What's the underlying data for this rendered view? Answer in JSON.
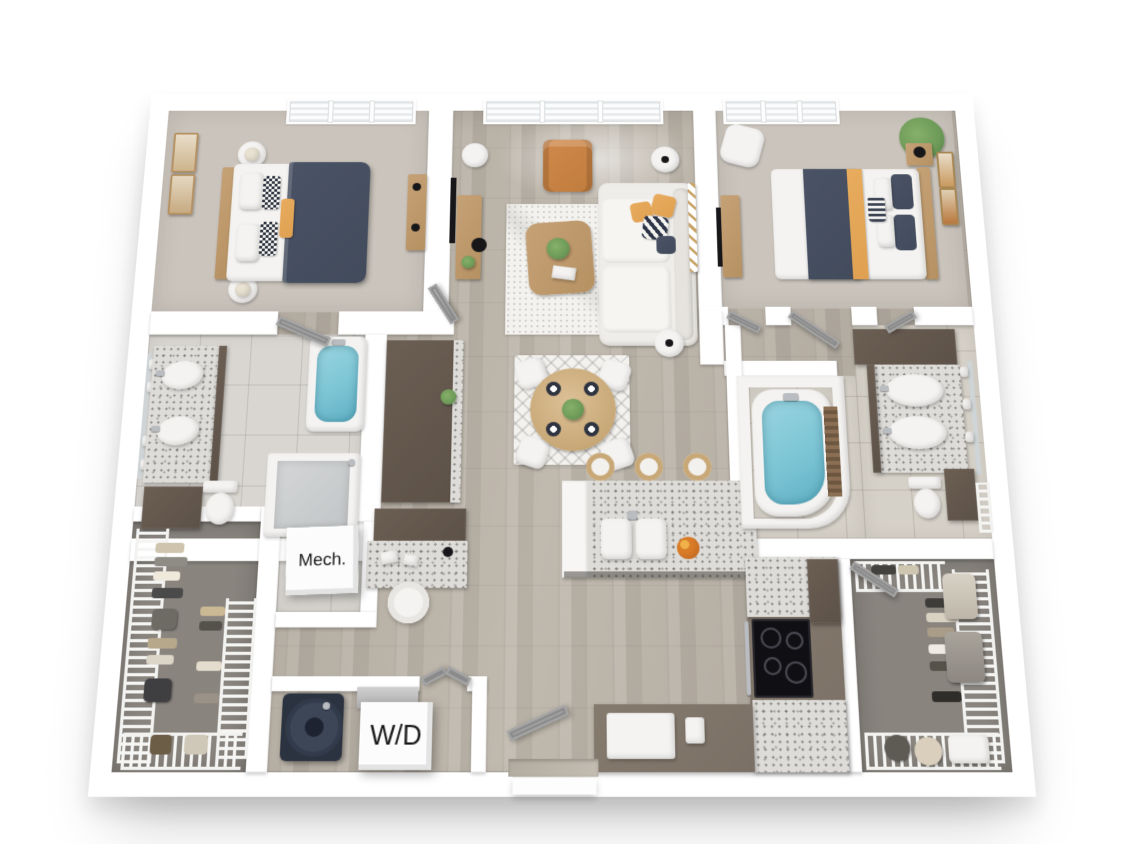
{
  "labels": {
    "mech": "Mech.",
    "wd": "W/D"
  },
  "colors": {
    "wall": "#ffffff",
    "wood": "#c0b9ae",
    "wood2": "#aba398",
    "carpet": "#cac4bc",
    "carpet_dark": "#89847e",
    "tile": "#d9d6d1",
    "tile_beige": "#d6d1c8",
    "granite": "#dedcd8",
    "cabinet_dark": "#5d5248",
    "cabinet_taupe": "#7b7065",
    "wood_furniture": "#b59162",
    "navy": "#424b5c",
    "orange": "#dfa051",
    "leather": "#c07c3e",
    "teal": "#7cc5d5",
    "plant": "#6d9a58",
    "sofa": "#efede9",
    "rug": "#f4f2ee",
    "door": "#9b9b9b",
    "black": "#17171a",
    "steel": "#b9bcc0"
  }
}
